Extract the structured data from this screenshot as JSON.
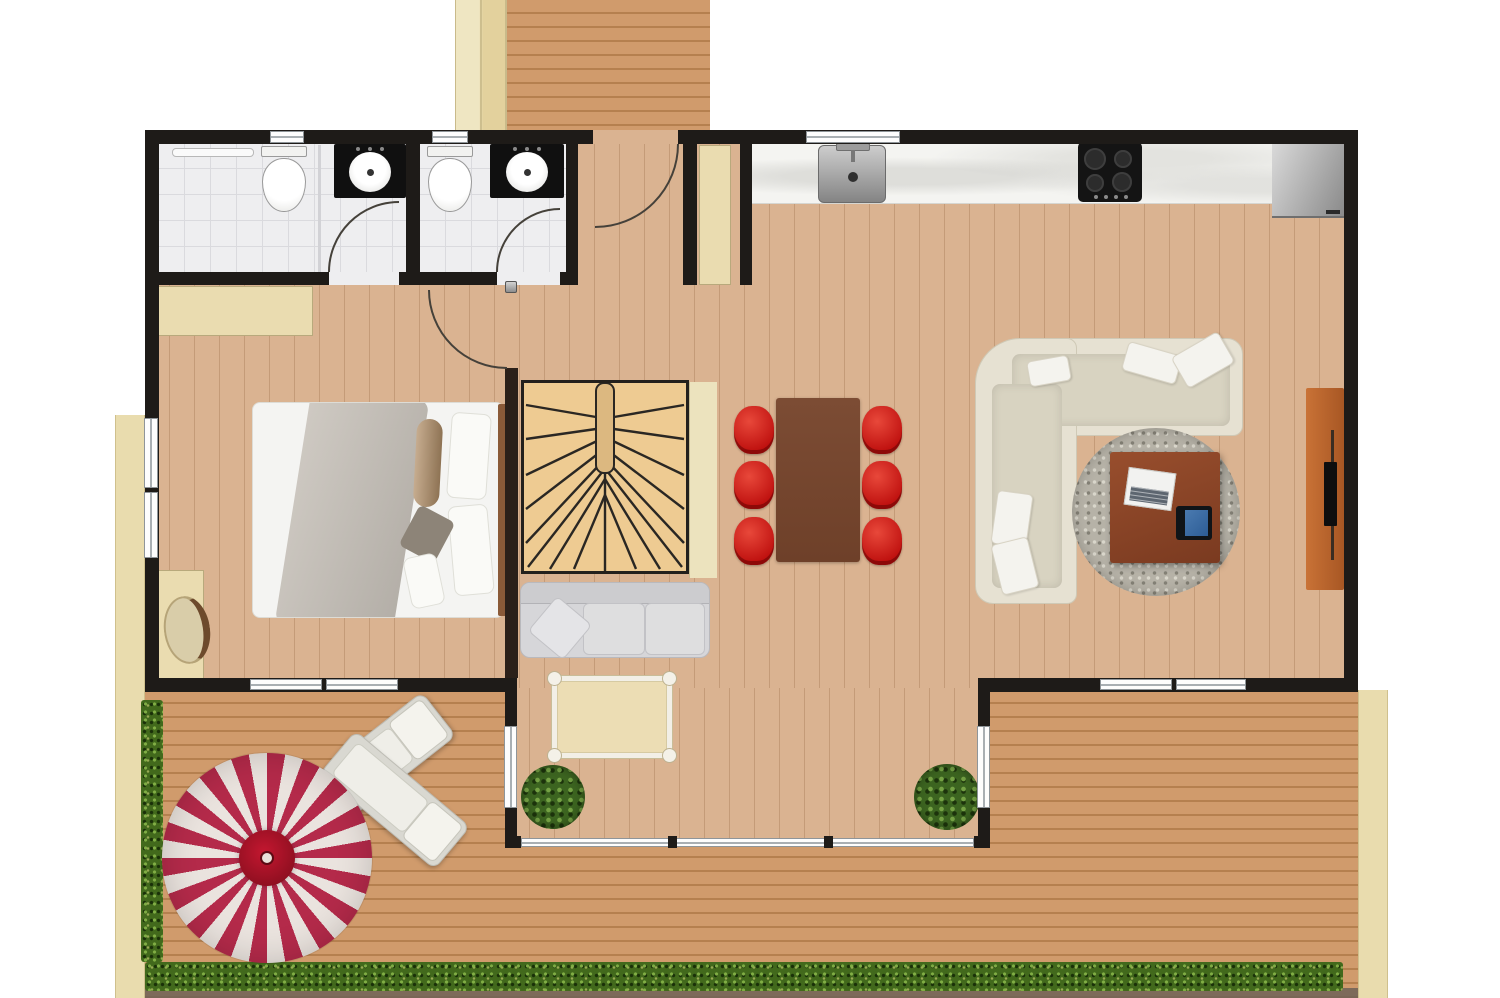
{
  "scene": {
    "type": "floor-plan-top-view",
    "canvas": {
      "width_px": 1500,
      "height_px": 998
    }
  },
  "palette": {
    "wall": "#1e1b18",
    "interior_floor": "#dab391",
    "deck": "#d09b6c",
    "deck_line": "#b5804f",
    "path_beige": "#e9dcae",
    "tile_floor": "#eeeef0",
    "tile_line": "#dadade",
    "counter_marble": "#f4f4f1",
    "counter_black": "#101010",
    "stair_tread": "#eecb92",
    "landing_beige": "#ece3be",
    "wardrobe_beige": "#eadcb0",
    "bed_white": "#f4f4f2",
    "headboard": "#8a5a38",
    "sofa_small": "#d6d6d9",
    "mat_beige": "#ecddb4",
    "table_brown": "#744630",
    "chair_red": "#c01210",
    "sofa_cream": "#e6e1d2",
    "rug_gray": "#b6b2a7",
    "coffee_table": "#8e4a2c",
    "tv_unit": "#c06a31",
    "parasol_red": "#b42a4a",
    "parasol_white": "#eae3de",
    "parasol_center": "#8e0f20",
    "hedge": "#42691c",
    "plant": "#3c6420",
    "lounger": "#d9d8d1"
  },
  "rooms": [
    {
      "name": "bathroom-1",
      "floor": "tile",
      "fixtures": [
        "toilet",
        "washbasin",
        "shower-area",
        "inward-door",
        "window"
      ]
    },
    {
      "name": "bathroom-2",
      "floor": "tile",
      "fixtures": [
        "toilet",
        "washbasin",
        "inward-door",
        "window"
      ]
    },
    {
      "name": "entry-hall",
      "floor": "wood",
      "fixtures": [
        "front-door",
        "closet"
      ]
    },
    {
      "name": "kitchen",
      "floor": "wood",
      "fixtures": [
        "countertop",
        "sink",
        "cooktop",
        "refrigerator",
        "window"
      ]
    },
    {
      "name": "bedroom",
      "floor": "wood",
      "fixtures": [
        "double-bed",
        "wardrobe",
        "desk",
        "stool",
        "windows",
        "door"
      ]
    },
    {
      "name": "living-dining-area",
      "floor": "wood",
      "fixtures": [
        "winder-staircase",
        "loveseat",
        "floor-mat",
        "dining-table",
        "dining-chairs",
        "corner-sofa",
        "round-rug",
        "coffee-table",
        "laptop-tray",
        "tablet",
        "tv-sideboard",
        "potted-plants",
        "glazed-bay"
      ]
    },
    {
      "name": "terrace",
      "floor": "decking",
      "fixtures": [
        "parasol",
        "sun-loungers",
        "hedge-left",
        "hedge-bottom",
        "walkway",
        "top-deck"
      ]
    }
  ],
  "counts": {
    "dining_chairs": 6,
    "sun_loungers": 2,
    "potted_plants": 2,
    "toilets": 2,
    "washbasins": 2
  }
}
